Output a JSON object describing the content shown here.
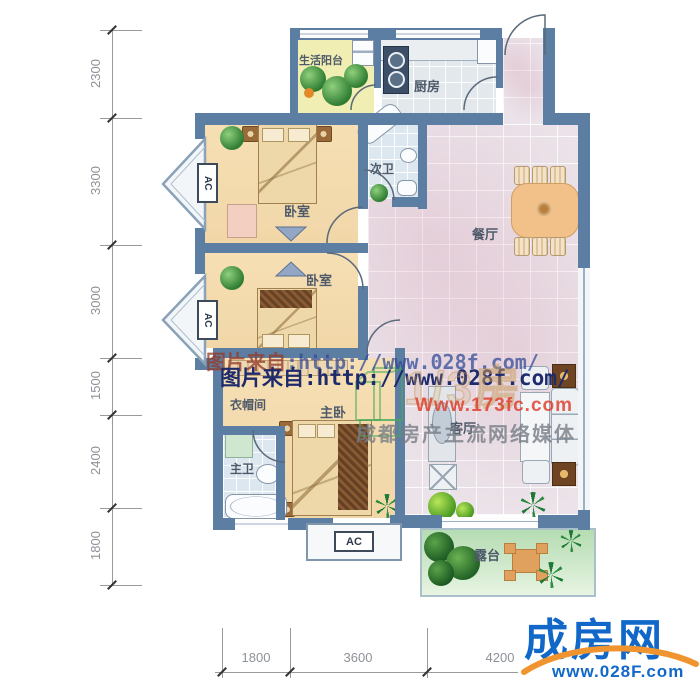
{
  "plan": {
    "rooms": {
      "balcony": "生活阳台",
      "kitchen": "厨房",
      "bath2": "次卫",
      "dining": "餐厅",
      "bedroom1": "卧室",
      "bedroom2": "卧室",
      "closet": "衣帽间",
      "master": "主卧",
      "bath1": "主卫",
      "living": "客厅",
      "terrace": "露台"
    },
    "ac_label": "AC"
  },
  "dimensions": {
    "left": [
      "2300",
      "3300",
      "3000",
      "1500",
      "2400",
      "1800"
    ],
    "bottom": [
      "1800",
      "3600",
      "4200"
    ]
  },
  "watermarks": {
    "source_prefix": "图片来自",
    "source_url": ":http://www.028f.com/",
    "source_full": "图片来自:http://www.028f.com/",
    "brand_outline": "1/3房",
    "brand_url": "Www.173fc.com",
    "media": "成都房产主流网络媒体"
  },
  "logo": {
    "brand": "成房网",
    "url": "www.028F.com"
  },
  "colors": {
    "wall": "#5d7ea3",
    "logo_blue": "#1168c8",
    "logo_orange": "#f09430",
    "watermark_navy": "#1d2a6b"
  }
}
